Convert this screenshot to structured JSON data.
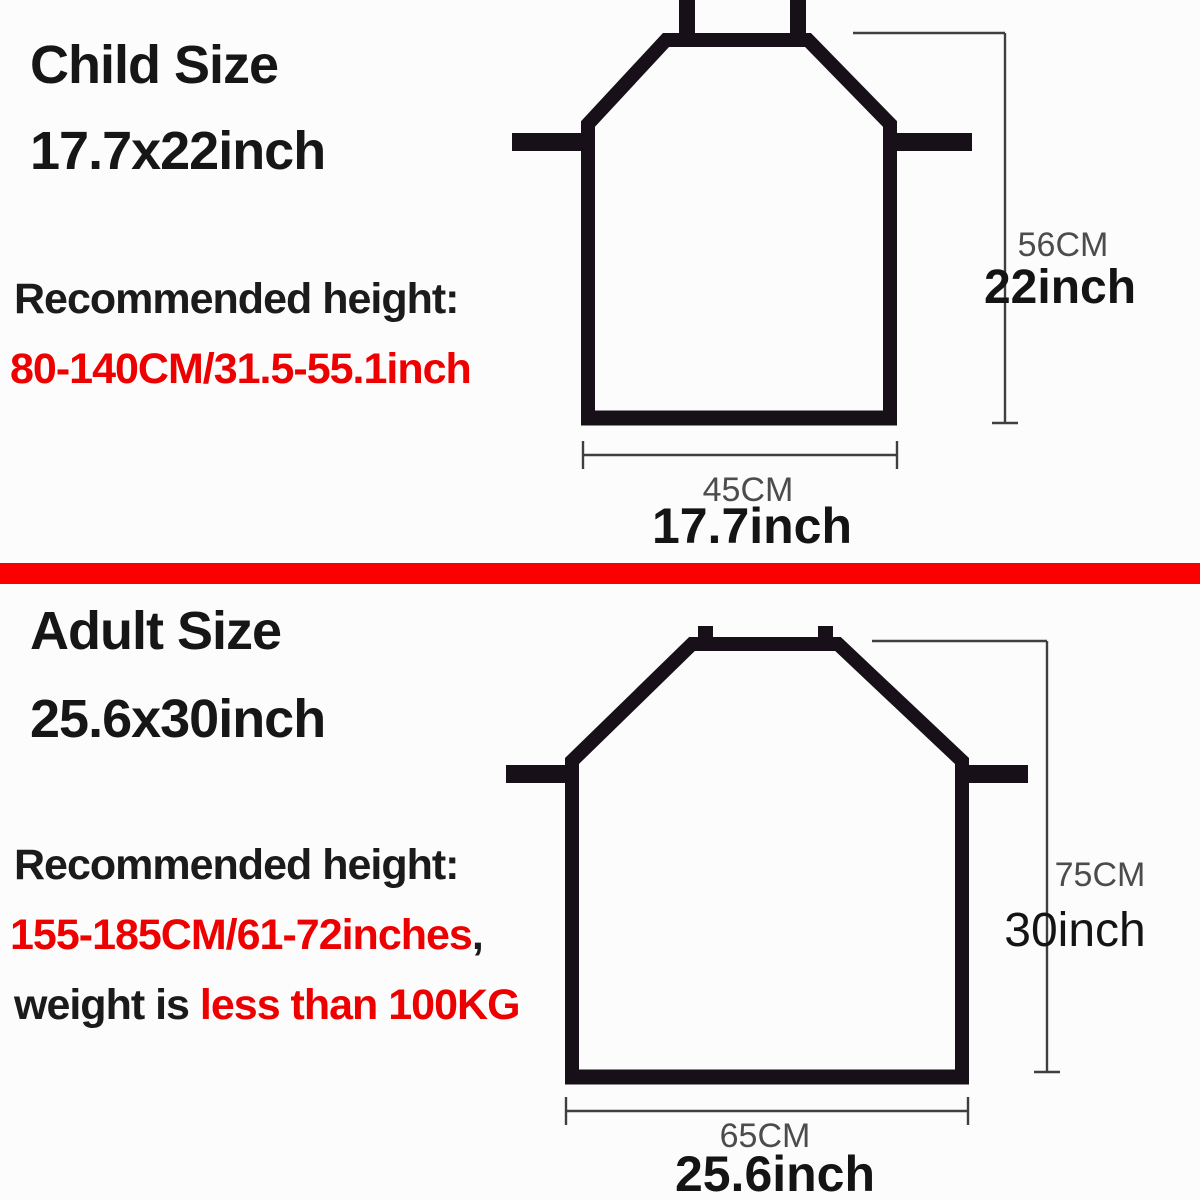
{
  "colors": {
    "divider_red": "#fb0000",
    "text_red": "#ee0000",
    "text_black": "#1b1b1b",
    "apron_outline": "#171019",
    "dimension_gray": "#4c4c4c"
  },
  "child": {
    "title": "Child Size",
    "size": "17.7x22inch",
    "recommended_label": "Recommended height:",
    "recommended_value": "80-140CM/31.5-55.1inch",
    "height_cm": "56CM",
    "height_inch": "22inch",
    "width_cm": "45CM",
    "width_inch": "17.7inch"
  },
  "adult": {
    "title": "Adult Size",
    "size": "25.6x30inch",
    "recommended_label": "Recommended height:",
    "recommended_value": "155-185CM/61-72inches",
    "recommended_suffix": ",",
    "weight_prefix": "weight is ",
    "weight_value": "less than 100KG",
    "height_cm": "75CM",
    "height_inch": "30inch",
    "width_cm": "65CM",
    "width_inch": "25.6inch"
  }
}
